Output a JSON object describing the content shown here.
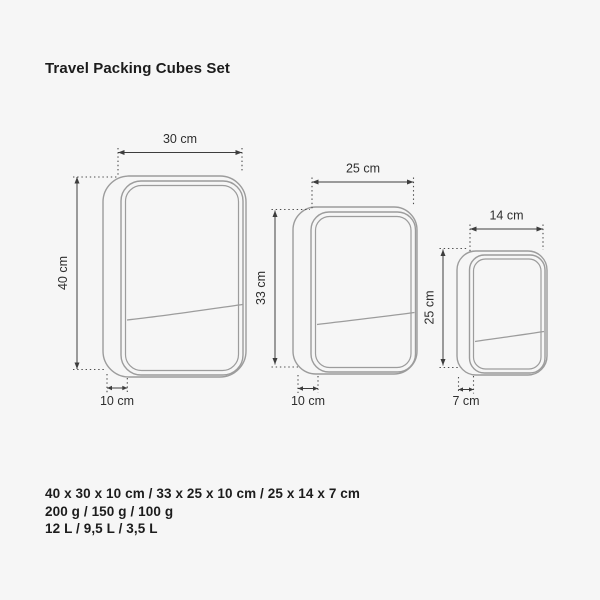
{
  "title": "Travel Packing Cubes Set",
  "cubes": [
    {
      "name": "large",
      "width_label": "30 cm",
      "height_label": "40 cm",
      "depth_label": "10 cm"
    },
    {
      "name": "medium",
      "width_label": "25 cm",
      "height_label": "33 cm",
      "depth_label": "10 cm"
    },
    {
      "name": "small",
      "width_label": "14 cm",
      "height_label": "25 cm",
      "depth_label": "7 cm"
    }
  ],
  "specs": {
    "dimensions": "40 x 30 x 10 cm / 33 x 25 x 10 cm / 25 x 14 x 7 cm",
    "weights": "200 g / 150 g / 100 g",
    "volumes": "12 L / 9,5 L / 3,5 L"
  },
  "colors": {
    "background": "#f6f6f6",
    "cube_outline": "#9c9c9c",
    "dimension_lines": "#3d3d3d",
    "text": "#1c1c1c"
  }
}
